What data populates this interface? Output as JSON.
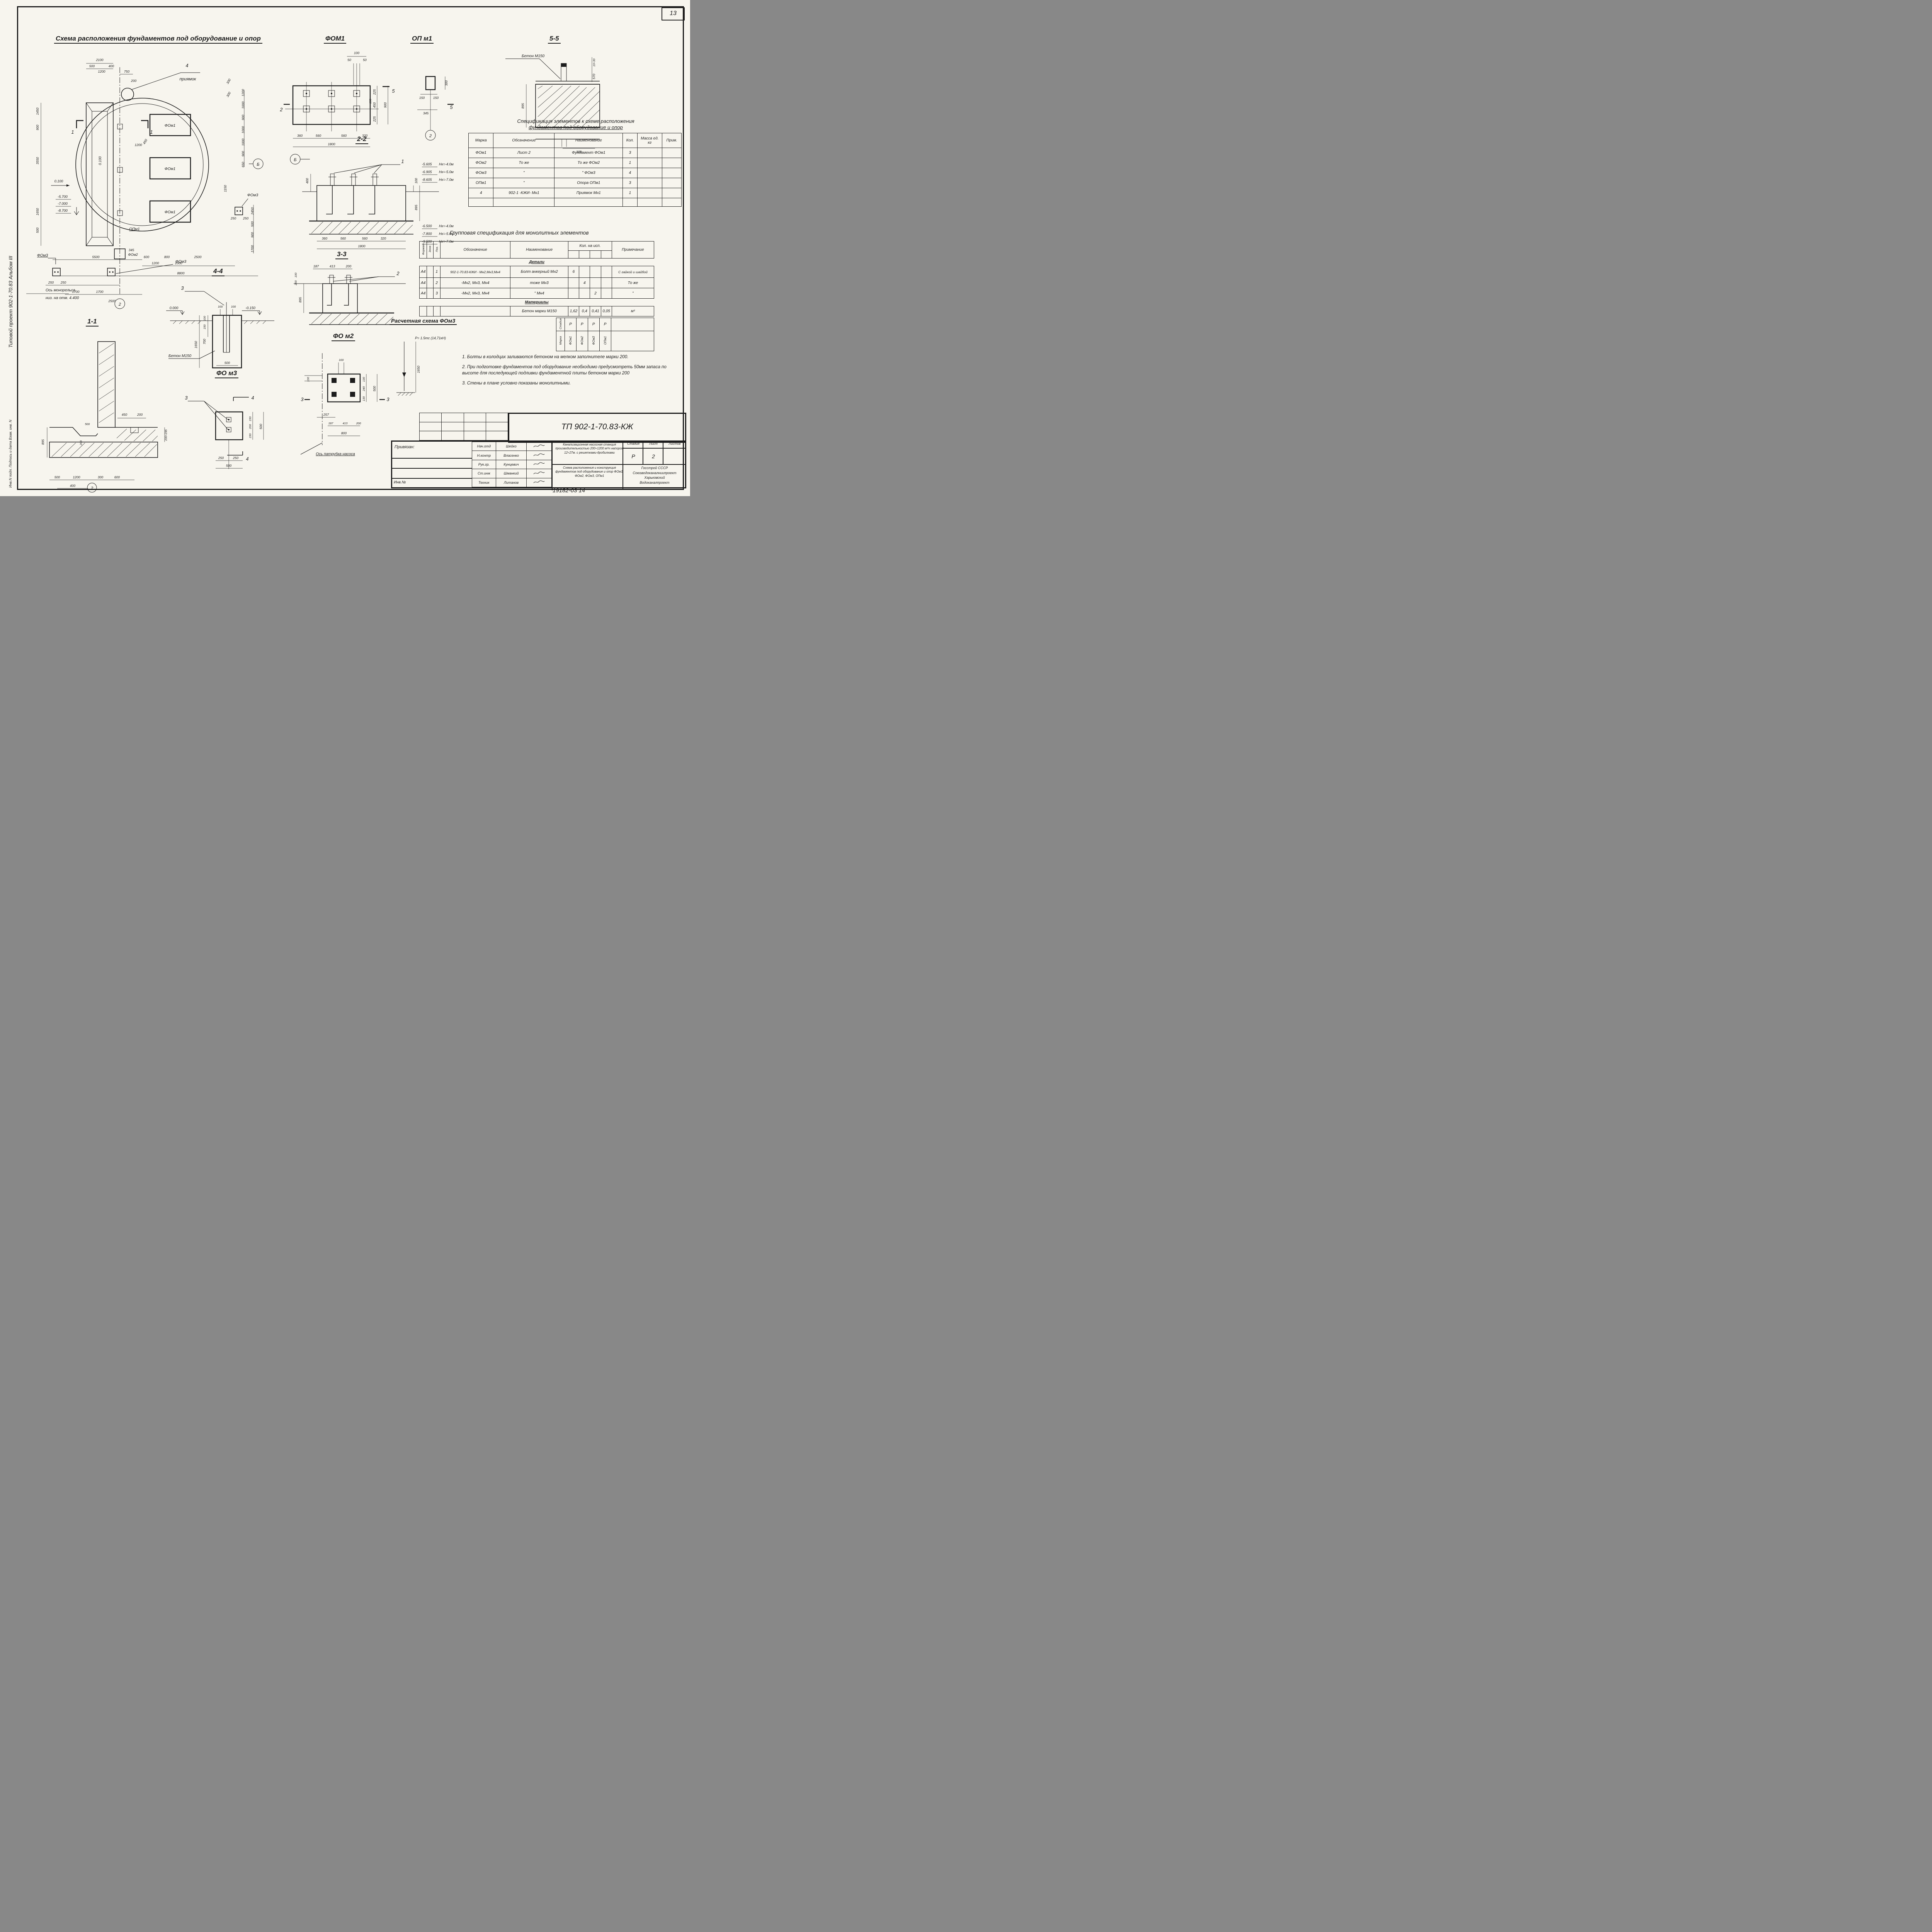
{
  "sheet": {
    "page": "13",
    "side_top": "Типовой проект 902-1-70.83      Альбом III",
    "side_bottom": "Инв.N подл.       Подпись и дата       Взам. инв. N",
    "archive": "19182-03    14"
  },
  "plan": {
    "title": "Схема расположения фундаментов под оборудование и опор",
    "labels": {
      "pit_no": "4",
      "pit": "приямок",
      "fom1": "ФОм1",
      "fom2": "ФОм2",
      "fom3": "ФОм3",
      "opm1": "ОПм1",
      "axis2": "2",
      "axisB": "Б",
      "sec1": "1",
      "elev_slab": "0.100",
      "elev_rot": "0.100",
      "e1": "-5.700",
      "e2": "-7.000",
      "e3": "-8.700",
      "monorail1": "Ось монорельса",
      "monorail2": "низ. на отм. 4.400"
    },
    "dims": [
      "2100",
      "500",
      "1200",
      "400",
      "750",
      "1450",
      "900",
      "3550",
      "1650",
      "500",
      "5500",
      "600",
      "1200",
      "800",
      "1000",
      "2500",
      "8800",
      "250",
      "250",
      "1700",
      "1700",
      "2500",
      "1200",
      "1000",
      "900",
      "1000",
      "1000",
      "900",
      "650",
      "2450",
      "500",
      "900",
      "1700",
      "1150",
      "250",
      "250",
      "345",
      "450",
      "200",
      "1200",
      "300",
      "300"
    ]
  },
  "details": {
    "fom1": {
      "title": "ФОМ1",
      "sec2": "2",
      "sec5": "5",
      "dims": [
        "100",
        "50",
        "50",
        "225",
        "450",
        "225",
        "900",
        "100",
        "360",
        "560",
        "560",
        "320",
        "1800"
      ]
    },
    "opm1": {
      "title": "ОП м1",
      "axis": "2",
      "sec": "5",
      "dims": [
        "300",
        "150",
        "150",
        "345"
      ]
    },
    "s55": {
      "title": "5-5",
      "concrete": "Бетон М150",
      "dims": [
        "10÷30",
        "570",
        "895",
        "300"
      ]
    },
    "s22": {
      "title": "2-2",
      "axis": "Б",
      "callout": "1",
      "dims": [
        "400",
        "100",
        "895",
        "360",
        "560",
        "560",
        "320",
        "1800"
      ],
      "elev_top": [
        [
          "-5.605",
          "Нк=-4.0м"
        ],
        [
          "-6.905",
          "Нк=-5.0м"
        ],
        [
          "-8.605",
          "Нк=-7.0м"
        ]
      ],
      "elev_bot": [
        [
          "-6.500",
          "Нк=-4.0м"
        ],
        [
          "-7.800",
          "Нк=-5.0м"
        ],
        [
          "-9.500",
          "Нк=-7.0м"
        ]
      ]
    },
    "s33": {
      "title": "3-3",
      "callout": "2",
      "dims": [
        "187",
        "413",
        "200",
        "895",
        "100",
        "200"
      ]
    },
    "s44": {
      "title": "4-4",
      "callout": "3",
      "concrete": "Бетон М150",
      "elevA": "0.000",
      "elevB": "-0.150",
      "dims": [
        "100",
        "100",
        "100",
        "150",
        "700",
        "1650",
        "500"
      ]
    },
    "s11": {
      "title": "1-1",
      "axis": "2",
      "dims": [
        "895",
        "450",
        "200",
        "500",
        "200",
        "200÷295",
        "500",
        "1200",
        "300",
        "600",
        "400"
      ]
    },
    "fom3": {
      "title": "ФО м3",
      "callout": "3",
      "sec": "4",
      "dims": [
        "150",
        "200",
        "150",
        "500",
        "250",
        "250",
        "500"
      ]
    },
    "fom2": {
      "title": "ФО м2",
      "sec": "3",
      "pump_axis": "Ось патрубка насоса",
      "dims": [
        "100",
        "100",
        "130",
        "240",
        "130",
        "500",
        "257",
        "187",
        "413",
        "200",
        "800"
      ]
    },
    "calc": {
      "title": "Расчетная схема ФОм3",
      "load": "Р= 1.5тс (14,71кН)",
      "dim": "1650"
    }
  },
  "spec_table": {
    "title1": "Спецификация элементов к схеме расположения",
    "title2": "фундаментов под оборудование и опор",
    "headers": [
      "Марка",
      "Обозначение",
      "Наименование",
      "Кол.",
      "Масса ед. кг",
      "Прим."
    ],
    "rows": [
      [
        "ФОм1",
        "Лист 2",
        "Фундамент ФОм1",
        "3",
        "",
        ""
      ],
      [
        "ФОм2",
        "То же",
        "То же   ФОм2",
        "1",
        "",
        ""
      ],
      [
        "ФОм3",
        "\"",
        "\"    ФОм3",
        "4",
        "",
        ""
      ],
      [
        "ОПм1",
        "\"",
        "Опора   ОПм1",
        "3",
        "",
        ""
      ],
      [
        "4",
        "902-1 -КЖИ- Мн1",
        "Приямок Мн1",
        "1",
        "",
        ""
      ],
      [
        "",
        "",
        "",
        "",
        "",
        ""
      ]
    ]
  },
  "group_table": {
    "title": "Групповая спецификация  для  монолитных элементов",
    "h_format": "Формат",
    "h_zone": "Зона",
    "h_pos": "Поз.",
    "h_oboz": "Обозначение",
    "h_naim": "Наименование",
    "h_qty": "Кол. на исп.",
    "h_note": "Примечание",
    "sec_details": "Детали",
    "sec_materials": "Материалы",
    "rows": [
      [
        "А4",
        "",
        "1",
        "902-1-70.83-КЖИ - Мн2,Мн3,Мн4",
        "Болт анкерный Мн2",
        "6",
        "",
        "",
        "",
        "С гайкой и шайбой"
      ],
      [
        "А4",
        "",
        "2",
        "-Мн2, Мн3, Мн4",
        "тоже   Мн3",
        "",
        "4",
        "",
        "",
        "То же"
      ],
      [
        "А4",
        "",
        "3",
        "-Мн2, Мн3, Мн4",
        "\"      Мн4",
        "",
        "",
        "2",
        "",
        "\""
      ]
    ],
    "materials_row": [
      "Бетон марки М150",
      "1,62",
      "0,4",
      "0,41",
      "0,05",
      "м³"
    ],
    "stamp": {
      "stage_label": "Стадия",
      "mark_label": "Марка",
      "stages": [
        "Р",
        "Р",
        "Р",
        "Р"
      ],
      "marks": [
        "ФОм1",
        "ФОм2",
        "ФОм3",
        "ОПм1"
      ]
    }
  },
  "notes": {
    "items": [
      "1. Болты в колодцах заливаются бетоном на мелком запол­нителе   марки  200.",
      "2. При  подготовке фундаментов под оборудование  необходимо предусмотреть 50мм запаса по высоте для  последующей под­ливки  фундаментной  плиты  бетоном  марки 200",
      "3. Стены в плане   условно  показаны  монолитными."
    ]
  },
  "title_block": {
    "doc_code": "ТП 902-1-70.83-КЖ",
    "privyazan": "Привязан:",
    "roles": [
      [
        "Нач.отд",
        "Шейко"
      ],
      [
        "Н.контр",
        "Власенко"
      ],
      [
        "Рук.гр.",
        "Кунцевич"
      ],
      [
        "Ст.инж",
        "Шманкий"
      ],
      [
        "Техник",
        "Литанов"
      ]
    ],
    "project": "Канализационная насосная станция производительностью 200÷1200 м³/ч напором 12÷27м. с решетками-дробилками",
    "drawing": "Схема расположения и кон­струкция фундаментов под оборудование и опор ФОм1, ФОм2, ФОм3, ОПм1",
    "stage_label": "Стадия",
    "sheet_label": "Лист",
    "sheets_label": "Листов",
    "stage": "Р",
    "sheet": "2",
    "org": [
      "Госстрой СССР",
      "Союзводоканалниипроект",
      "Харьковский",
      "Водоканалпроект"
    ],
    "inv": "Инв.№"
  }
}
